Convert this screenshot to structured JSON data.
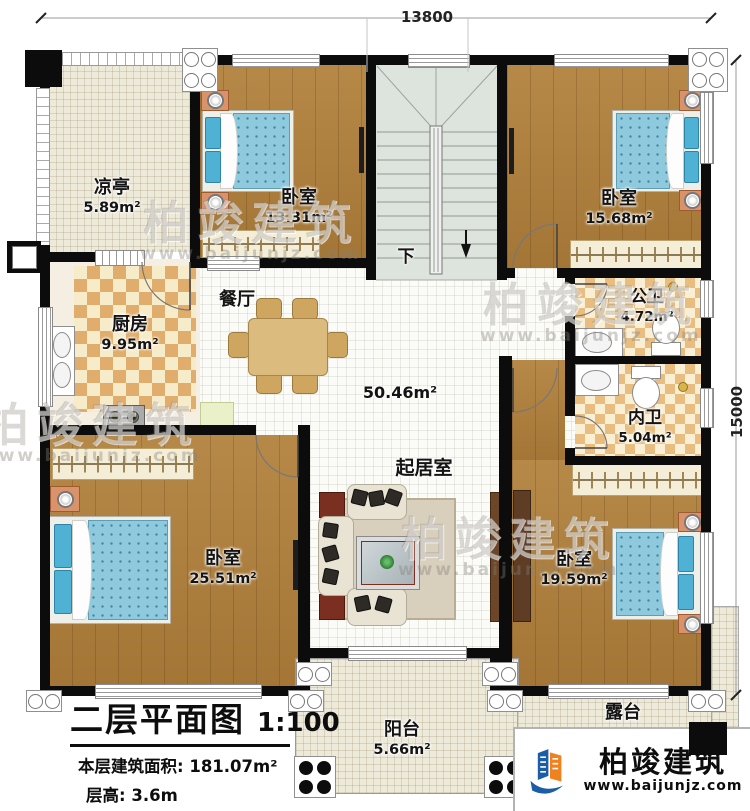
{
  "dimensions": {
    "width_top": "13800",
    "height_right": "15000"
  },
  "stairs": {
    "down": "下"
  },
  "rooms": {
    "pavilion": {
      "name": "凉亭",
      "area": "5.89m²"
    },
    "bedroom_tl": {
      "name": "卧室",
      "area": "13.31m²"
    },
    "bedroom_tr": {
      "name": "卧室",
      "area": "15.68m²"
    },
    "kitchen": {
      "name": "厨房",
      "area": "9.95m²"
    },
    "dining": {
      "name": "餐厅"
    },
    "living": {
      "name": "起居室",
      "area": "50.46m²"
    },
    "bath_public": {
      "name": "公卫",
      "area": "4.72m²"
    },
    "bath_private": {
      "name": "内卫",
      "area": "5.04m²"
    },
    "bedroom_bl": {
      "name": "卧室",
      "area": "25.51m²"
    },
    "bedroom_br": {
      "name": "卧室",
      "area": "19.59m²"
    },
    "balcony": {
      "name": "阳台",
      "area": "5.66m²"
    },
    "terrace": {
      "name": "露台"
    }
  },
  "title_block": {
    "title": "二层平面图",
    "scale": "1:100",
    "area_line": "本层建筑面积: 181.07m²",
    "height_line": "层高: 3.6m"
  },
  "branding": {
    "company": "柏竣建筑",
    "website": "www.baijunjz.com"
  },
  "watermark": {
    "text": "柏竣建筑",
    "url": "www.baijunjz.com"
  },
  "colors": {
    "wall": "#0c0c0c",
    "wood": "#b1803b",
    "mattress": "#8ec9de",
    "checker_tan": "#e0ad6c",
    "floor_cream": "#eeeada",
    "logo_blue": "#1b5ea6",
    "logo_orange": "#f0821e"
  }
}
